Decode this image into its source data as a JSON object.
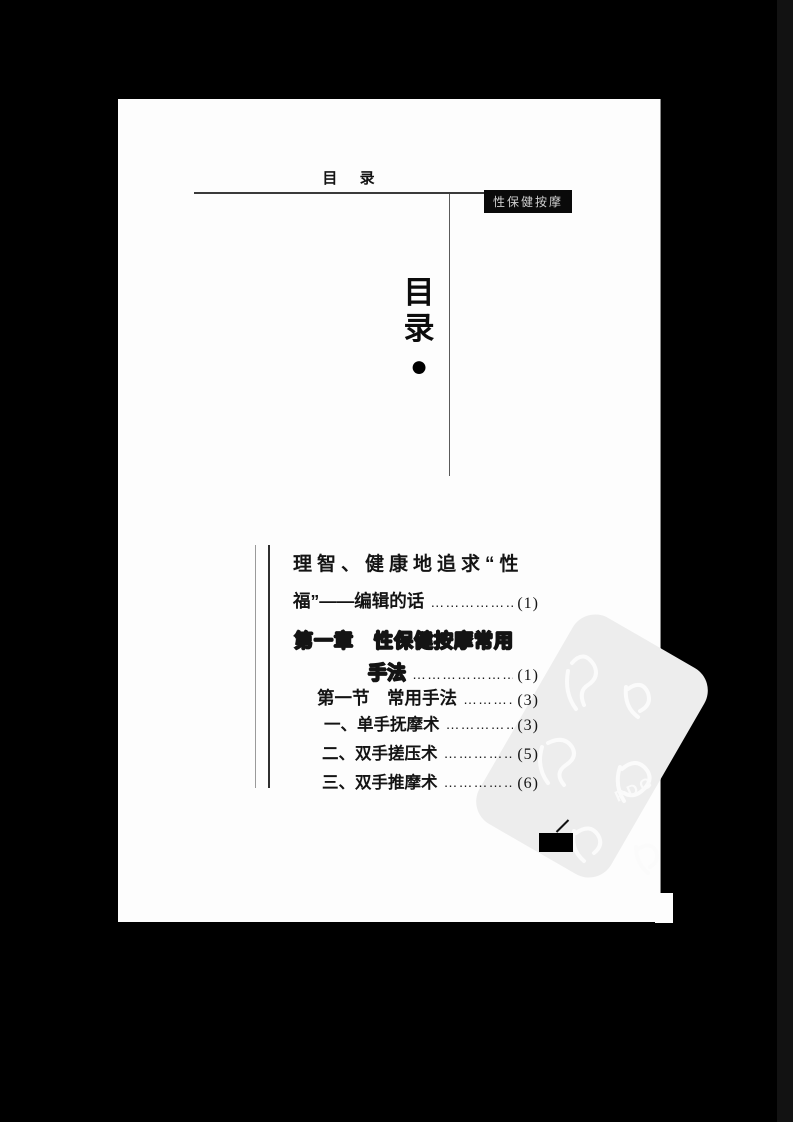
{
  "scan": {
    "header": {
      "title": "目 录",
      "corner_label": "性保健按摩"
    },
    "vertical_title": {
      "top_char": "目",
      "bottom_char": "录",
      "bullet": "●"
    },
    "toc": {
      "lines": [
        {
          "text": "理智、健康地追求“性",
          "dots": "",
          "page": ""
        },
        {
          "text": "福”——编辑的话",
          "dots": "……………………………",
          "page": "(1)"
        },
        {
          "text": "第一章　性保健按摩常用",
          "dots": "",
          "page": ""
        },
        {
          "text": "手法",
          "dots": "……………………………",
          "page": "(1)"
        },
        {
          "text": "第一节　常用手法",
          "dots": "……………………………",
          "page": "(3)"
        },
        {
          "text": "一、单手抚摩术",
          "dots": "……………………………",
          "page": "(3)"
        },
        {
          "text": "二、双手搓压术",
          "dots": "……………………………",
          "page": "(5)"
        },
        {
          "text": "三、双手推摩术",
          "dots": "……………………………",
          "page": "(6)"
        }
      ]
    },
    "watermark": {
      "label": "PDG"
    },
    "colors": {
      "background": "#000000",
      "page": "#fdfdfd",
      "ink": "#141414",
      "corner_label_bg": "#0a0a0a",
      "watermark_band": "#ededed"
    }
  }
}
